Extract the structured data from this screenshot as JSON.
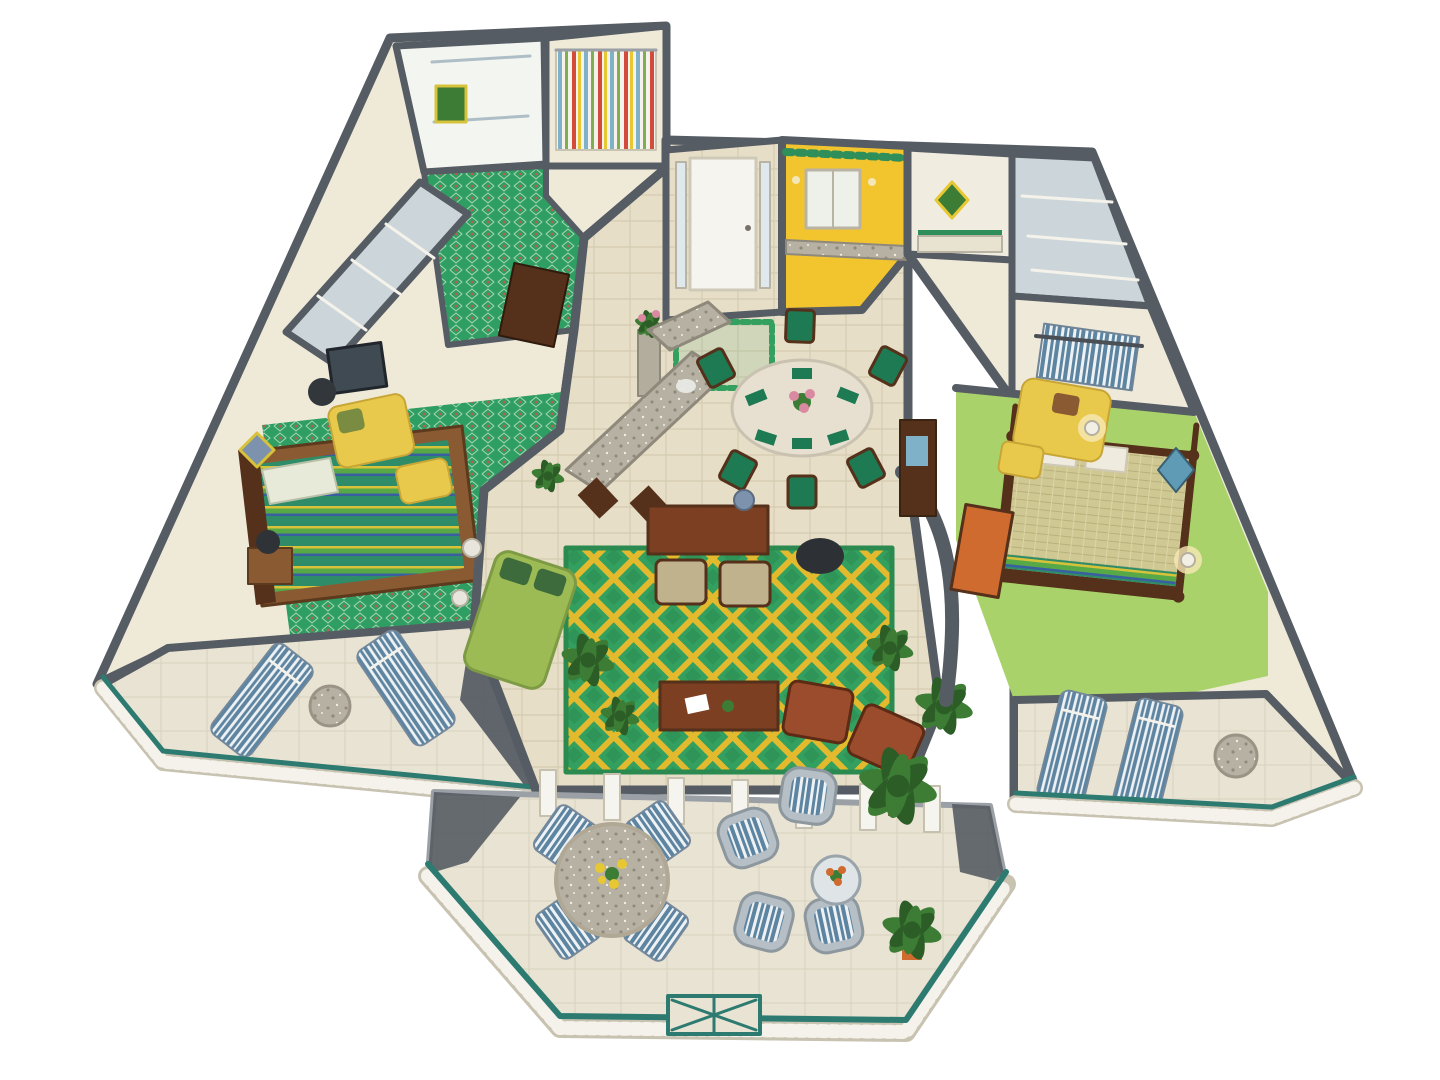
{
  "palette": {
    "background": "#ffffff",
    "wall": "#565c63",
    "wall_light": "#8a9097",
    "interior_wall": "#efe9d8",
    "floor_tile": "#e6dec7",
    "floor_tile_line": "#d6ccb2",
    "floor_stone": "#e9e3d3",
    "carpet_green": "#2f9e62",
    "rug_green": "#33a05f",
    "rug_green_dark": "#2a8a50",
    "rug_lattice": "#e3b92e",
    "carpet_lime": "#a9d36a",
    "kitchen_yellow": "#f2c52f",
    "valance_green": "#2f8f5a",
    "teal_rail": "#2d7a71",
    "baluster_white": "#f4f2ea",
    "stripe_blue": "#5d84a0",
    "stripe_white": "#eef2f4",
    "wood": "#8a5a33",
    "wood_dark": "#55301a",
    "wood_red": "#7c3f22",
    "granite": "#b7b1a3",
    "granite_dark": "#8f897c",
    "marble": "#e7e0d0",
    "khaki": "#cfc893",
    "chair_yellow": "#e9c94b",
    "sofa_green": "#9dbb55",
    "pillow_dark_green": "#3e6b3c",
    "dining_green": "#1e7a52",
    "plant": "#3c7c34",
    "plant_dark": "#2c5d27",
    "orange": "#cf6b2e",
    "pink": "#d98aa1",
    "glass": "#ccd6da",
    "door_white": "#f6f4ee",
    "lamp_blue": "#7d93ad",
    "curtain_red": "#d34b3a",
    "curtain_yellow": "#e8c832",
    "curtain_blue": "#7fb2c9",
    "curtain_green": "#7fae4e",
    "bed_stripe_teal": "#2e8d68",
    "bed_stripe_yellow": "#d8c23a",
    "bed_stripe_blue": "#3a5fa0",
    "bed_stripe_green": "#57a847",
    "brown_chair": "#9a4c2c",
    "terracotta": "#8a6b4a"
  },
  "scene": {
    "description": "3D floor plan rendering of a two-bedroom resort suite with central living room, kitchen, dining area, two bedroom suites with private balconies and a large octagonal patio terrace",
    "rooms": [
      "guest bathroom",
      "guest bathroom with striped curtain",
      "green tile hallway",
      "closet row",
      "guest bedroom",
      "guest balcony",
      "entry foyer",
      "kitchen",
      "breakfast bar",
      "dining area",
      "living room",
      "master bathroom",
      "linen closet",
      "walk-in closet",
      "master bedroom",
      "master balcony",
      "octagonal patio terrace"
    ],
    "furniture": [
      "striped guest bed",
      "yellow armchairs with ottomans",
      "floor lamp",
      "nightstands with lamps",
      "blue striped lounge chairs",
      "granite side tables",
      "white double entry door",
      "green bordered entry rug",
      "flower pedestal",
      "kitchen window and valance",
      "granite counters and island",
      "bar stools",
      "oval dining table with six green chairs",
      "pink floral centerpiece",
      "writing desk with lamp",
      "upholstered chairs",
      "coffee table",
      "green sofa with dark green pillows",
      "brown lounge chairs",
      "potted palms",
      "four-poster master bed with khaki spread",
      "orange bench",
      "wicker chairs with striped cushions",
      "round patio dining table with yellow flowers",
      "teal topped white railings",
      "decorative railing gate panel"
    ]
  }
}
